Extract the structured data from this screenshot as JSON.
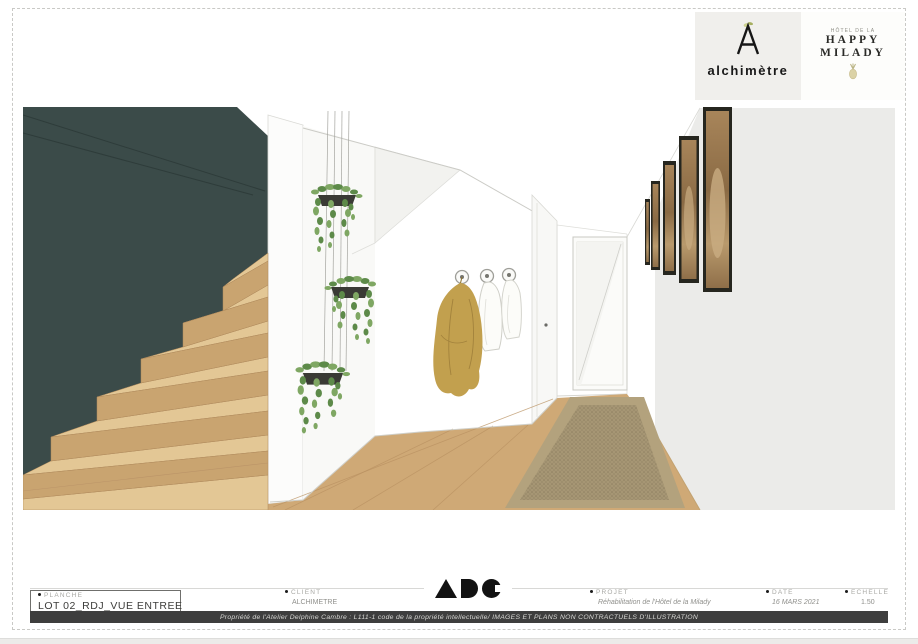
{
  "branding": {
    "alchimetre": {
      "wordmark": "alchimètre",
      "mark_icon": "alchimetre-a-monogram",
      "background": "#f0efec"
    },
    "happy_milady": {
      "topline": "HÔTEL DE LA",
      "line1": "HAPPY",
      "line2": "MILADY",
      "icon": "pineapple-icon"
    },
    "adc": {
      "letters": "ADC"
    }
  },
  "title_block": {
    "planche": {
      "label": "PLANCHE",
      "value": "LOT 02_RDJ_VUE ENTREE"
    },
    "client": {
      "label": "CLIENT",
      "value": "ALCHIMETRE"
    },
    "projet": {
      "label": "PROJET",
      "value": "Réhabilitation de l'Hôtel de la Milady"
    },
    "date": {
      "label": "DATE",
      "value": "16 MARS 2021"
    },
    "echelle": {
      "label": "ECHELLE",
      "value": "1.50"
    }
  },
  "footer": {
    "copyright": "Propriété de l'Atelier Delphine Cambre : L111-1 code de la propriété intellectuelle/ IMAGES ET PLANS NON CONTRACTUELS D'ILLUSTRATION"
  },
  "scene": {
    "colors": {
      "teal_wall": "#3b4b49",
      "stair_tread": "#e3c795",
      "stair_riser": "#c9a470",
      "wood_floor": "#cfa976",
      "rug_border": "#b3a27d",
      "rug_center": "#a69674",
      "coat": "#c2a04e",
      "leaf_light": "#7fa763",
      "leaf_dark": "#5d8a49",
      "planter": "#3a3a35",
      "right_wall": "#ebebe9",
      "frame": "#26261f",
      "artwork_wood": "#9a7a50"
    }
  }
}
